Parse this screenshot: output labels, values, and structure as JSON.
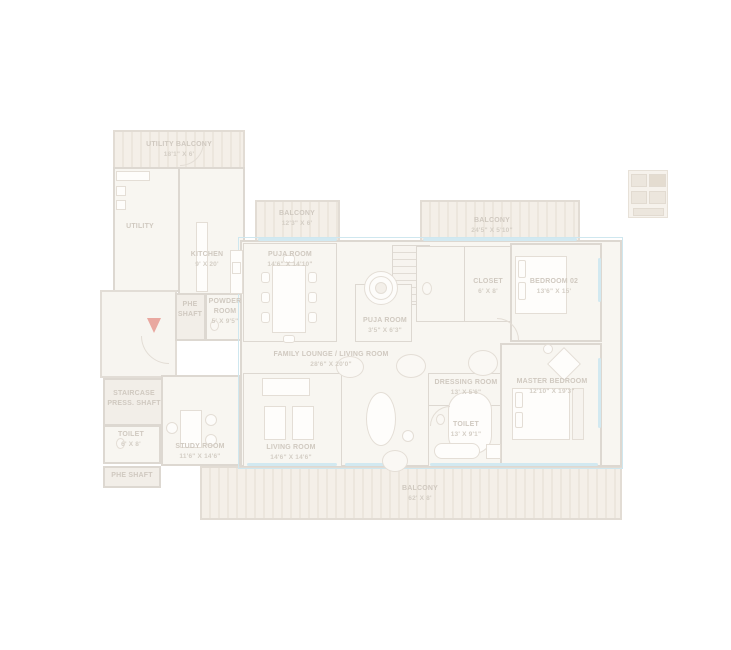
{
  "colors": {
    "wall": "#ddd8d1",
    "floor": "#f8f6f1",
    "balcony_stripe": "#ece6dd",
    "window_glass": "#d2e9f1",
    "unit_outline": "#cfe7ef",
    "label_text": "#d0c9c0",
    "entry_arrow": "#e9a8a0"
  },
  "rooms": {
    "utility_balcony": {
      "name": "UTILITY BALCONY",
      "dims": "18'1\" X 6'"
    },
    "utility": {
      "name": "UTILITY",
      "dims": ""
    },
    "kitchen": {
      "name": "KITCHEN",
      "dims": "9' X 20'"
    },
    "phe_shaft_upper": {
      "name": "PHE SHAFT",
      "dims": ""
    },
    "powder_room": {
      "name": "POWDER ROOM",
      "dims": "5' X 9'5\""
    },
    "balcony_top_center": {
      "name": "BALCONY",
      "dims": "12'3\" X 6'"
    },
    "puja_room_large": {
      "name": "PUJA ROOM",
      "dims": "14'6\" X 14'10\""
    },
    "puja_room_small": {
      "name": "PUJA ROOM",
      "dims": "3'5\" X 6'3\""
    },
    "balcony_top_right": {
      "name": "BALCONY",
      "dims": "24'5\" X 5'10\""
    },
    "closet": {
      "name": "CLOSET",
      "dims": "6' X 8'"
    },
    "bedroom_02": {
      "name": "BEDROOM 02",
      "dims": "13'6\" X 15'"
    },
    "family_lounge": {
      "name": "FAMILY LOUNGE / LIVING ROOM",
      "dims": "28'6\" X 20'0\""
    },
    "living_room": {
      "name": "LIVING ROOM",
      "dims": "14'6\" X 14'6\""
    },
    "dressing_room": {
      "name": "DRESSING ROOM",
      "dims": "13' X 5'6\""
    },
    "master_bedroom": {
      "name": "MASTER BEDROOM",
      "dims": "12'10\" X 19'3\""
    },
    "toilet_master": {
      "name": "TOILET",
      "dims": "13' X 9'1\""
    },
    "staircase_press_shaft": {
      "name": "STAIRCASE PRESS. SHAFT",
      "dims": ""
    },
    "toilet_common": {
      "name": "TOILET",
      "dims": "6' X 8'"
    },
    "phe_shaft_lower": {
      "name": "PHE SHAFT",
      "dims": ""
    },
    "study_room": {
      "name": "STUDY ROOM",
      "dims": "11'6\" X 14'6\""
    },
    "balcony_bottom": {
      "name": "BALCONY",
      "dims": "62' X 8'"
    }
  }
}
